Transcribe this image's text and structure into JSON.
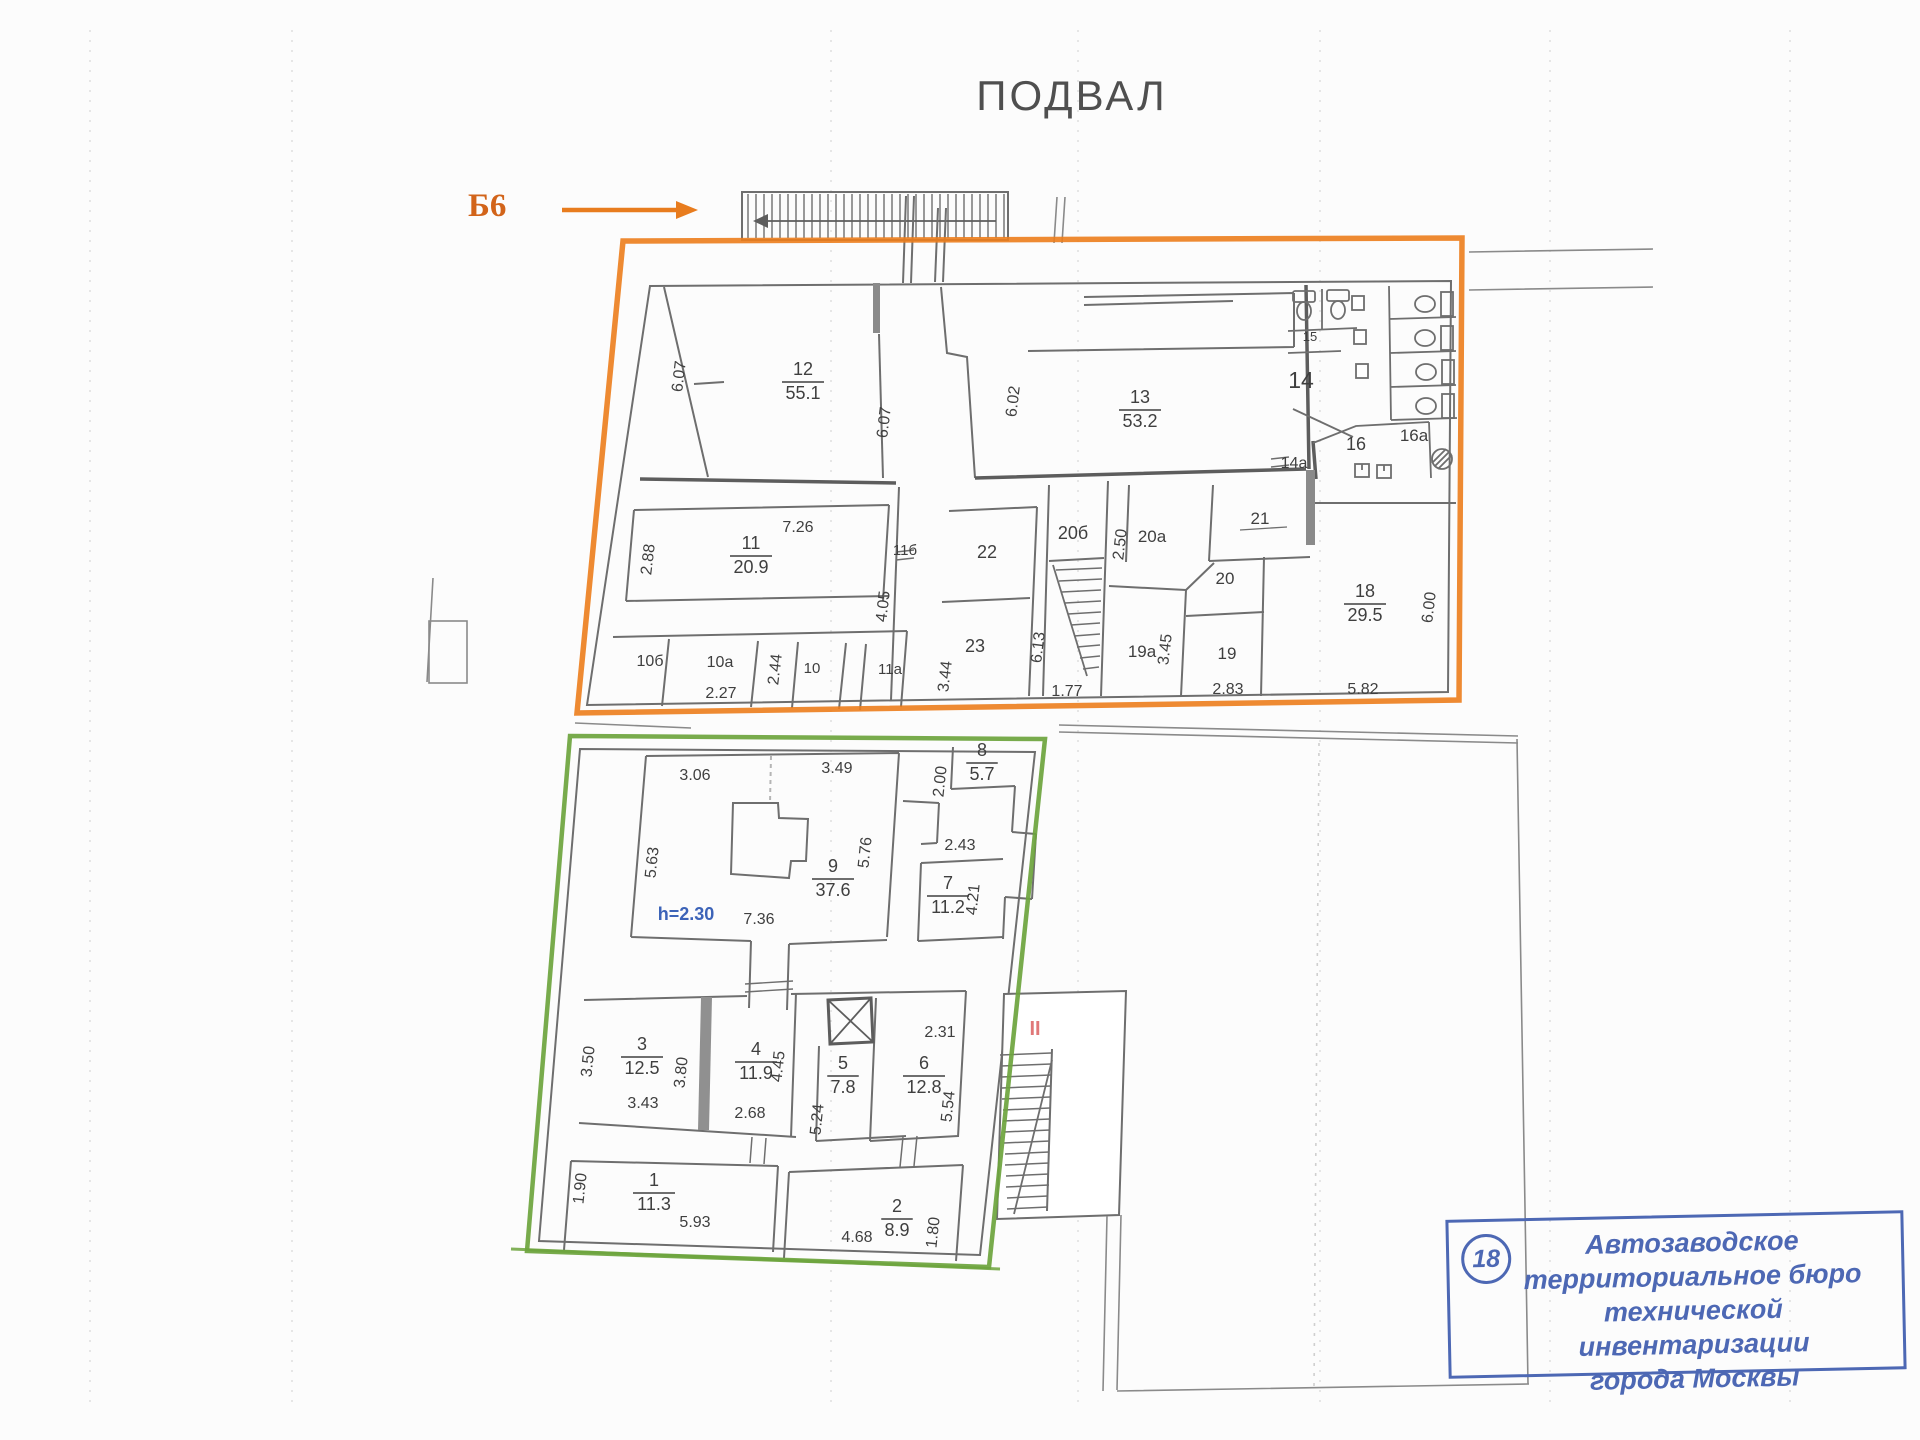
{
  "title": "ПОДВАЛ",
  "entrance_marker": {
    "label": "Б6"
  },
  "stamp": {
    "number": "18",
    "lines": [
      "Автозаводское",
      "территориальное бюро",
      "технической инвентаризации",
      "города Москвы"
    ]
  },
  "colors": {
    "upper_outline": "#ec7d1c",
    "lower_outline": "#6da43d",
    "marker": "#d2641a",
    "height_note": "#3c63b8",
    "section_mark": "#e07878",
    "stamp": "#4d68b4",
    "walls": "#6e6e6e",
    "text": "#3f3f3f"
  },
  "upper_plan": {
    "room_labels": [
      {
        "room": "12",
        "area": "55.1",
        "x": 803,
        "y": 375
      },
      {
        "room": "13",
        "area": "53.2",
        "x": 1140,
        "y": 403
      },
      {
        "room": "11",
        "area": "20.9",
        "x": 751,
        "y": 549
      },
      {
        "room": "18",
        "area": "29.5",
        "x": 1365,
        "y": 597
      }
    ],
    "room_numbers": [
      {
        "t": "14",
        "x": 1301,
        "y": 388,
        "s": 23
      },
      {
        "t": "15",
        "x": 1310,
        "y": 341,
        "s": 13
      },
      {
        "t": "16",
        "x": 1356,
        "y": 450,
        "s": 18
      },
      {
        "t": "16a",
        "x": 1414,
        "y": 441,
        "s": 17
      },
      {
        "t": "14a",
        "x": 1294,
        "y": 468,
        "s": 16
      },
      {
        "t": "21",
        "x": 1260,
        "y": 524,
        "s": 17
      },
      {
        "t": "22",
        "x": 987,
        "y": 558,
        "s": 18
      },
      {
        "t": "20б",
        "x": 1073,
        "y": 539,
        "s": 18
      },
      {
        "t": "20a",
        "x": 1152,
        "y": 542,
        "s": 17
      },
      {
        "t": "20",
        "x": 1225,
        "y": 584,
        "s": 17
      },
      {
        "t": "23",
        "x": 975,
        "y": 652,
        "s": 18
      },
      {
        "t": "19a",
        "x": 1142,
        "y": 657,
        "s": 17
      },
      {
        "t": "19",
        "x": 1227,
        "y": 659,
        "s": 17
      },
      {
        "t": "11a",
        "x": 890,
        "y": 674,
        "s": 15
      },
      {
        "t": "11б",
        "x": 905,
        "y": 555,
        "s": 15
      },
      {
        "t": "10б",
        "x": 650,
        "y": 666,
        "s": 16
      },
      {
        "t": "10a",
        "x": 720,
        "y": 667,
        "s": 16
      },
      {
        "t": "10",
        "x": 812,
        "y": 673,
        "s": 15
      }
    ],
    "dimensions": [
      {
        "t": "6.07",
        "x": 684,
        "y": 377,
        "r": -83
      },
      {
        "t": "6.07",
        "x": 889,
        "y": 423,
        "r": -83
      },
      {
        "t": "6.02",
        "x": 1018,
        "y": 402,
        "r": -83
      },
      {
        "t": "2.88",
        "x": 653,
        "y": 560,
        "r": -83
      },
      {
        "t": "7.26",
        "x": 798,
        "y": 532
      },
      {
        "t": "4.05",
        "x": 888,
        "y": 607,
        "r": -83
      },
      {
        "t": "2.50",
        "x": 1125,
        "y": 545,
        "r": -83
      },
      {
        "t": "3.44",
        "x": 950,
        "y": 677,
        "r": -83
      },
      {
        "t": "6.13",
        "x": 1043,
        "y": 648,
        "r": -83
      },
      {
        "t": "1.77",
        "x": 1067,
        "y": 696
      },
      {
        "t": "3.45",
        "x": 1170,
        "y": 650,
        "r": -83
      },
      {
        "t": "2.83",
        "x": 1228,
        "y": 694
      },
      {
        "t": "2.27",
        "x": 721,
        "y": 698
      },
      {
        "t": "2.44",
        "x": 780,
        "y": 670,
        "r": -83
      },
      {
        "t": "5.82",
        "x": 1363,
        "y": 694
      },
      {
        "t": "6.00",
        "x": 1434,
        "y": 608,
        "r": -83
      }
    ]
  },
  "lower_plan": {
    "room_labels": [
      {
        "room": "9",
        "area": "37.6",
        "x": 833,
        "y": 872
      },
      {
        "room": "8",
        "area": "5.7",
        "x": 982,
        "y": 756
      },
      {
        "room": "7",
        "area": "11.2",
        "x": 948,
        "y": 889
      },
      {
        "room": "3",
        "area": "12.5",
        "x": 642,
        "y": 1050
      },
      {
        "room": "4",
        "area": "11.9",
        "x": 756,
        "y": 1055
      },
      {
        "room": "5",
        "area": "7.8",
        "x": 843,
        "y": 1069
      },
      {
        "room": "6",
        "area": "12.8",
        "x": 924,
        "y": 1069
      },
      {
        "room": "1",
        "area": "11.3",
        "x": 654,
        "y": 1186
      },
      {
        "room": "2",
        "area": "8.9",
        "x": 897,
        "y": 1212
      }
    ],
    "dimensions": [
      {
        "t": "3.06",
        "x": 695,
        "y": 780
      },
      {
        "t": "3.49",
        "x": 837,
        "y": 773
      },
      {
        "t": "5.63",
        "x": 657,
        "y": 863,
        "r": -84
      },
      {
        "t": "5.76",
        "x": 870,
        "y": 853,
        "r": -84
      },
      {
        "t": "7.36",
        "x": 759,
        "y": 924
      },
      {
        "t": "2.00",
        "x": 945,
        "y": 782,
        "r": -84
      },
      {
        "t": "2.43",
        "x": 960,
        "y": 850
      },
      {
        "t": "4.21",
        "x": 978,
        "y": 900,
        "r": -84
      },
      {
        "t": "3.50",
        "x": 593,
        "y": 1062,
        "r": -84
      },
      {
        "t": "3.43",
        "x": 643,
        "y": 1108
      },
      {
        "t": "3.80",
        "x": 686,
        "y": 1073,
        "r": -84
      },
      {
        "t": "4.45",
        "x": 783,
        "y": 1067,
        "r": -84
      },
      {
        "t": "2.68",
        "x": 750,
        "y": 1118
      },
      {
        "t": "5.24",
        "x": 822,
        "y": 1120,
        "r": -84
      },
      {
        "t": "2.31",
        "x": 940,
        "y": 1037
      },
      {
        "t": "5.54",
        "x": 953,
        "y": 1107,
        "r": -84
      },
      {
        "t": "1.90",
        "x": 585,
        "y": 1189,
        "r": -84
      },
      {
        "t": "5.93",
        "x": 695,
        "y": 1227
      },
      {
        "t": "4.68",
        "x": 857,
        "y": 1242
      },
      {
        "t": "1.80",
        "x": 938,
        "y": 1233,
        "r": -84
      }
    ],
    "height_note": {
      "t": "h=2.30",
      "x": 686,
      "y": 920
    },
    "section_mark": {
      "t": "II",
      "x": 1035,
      "y": 1035
    }
  }
}
